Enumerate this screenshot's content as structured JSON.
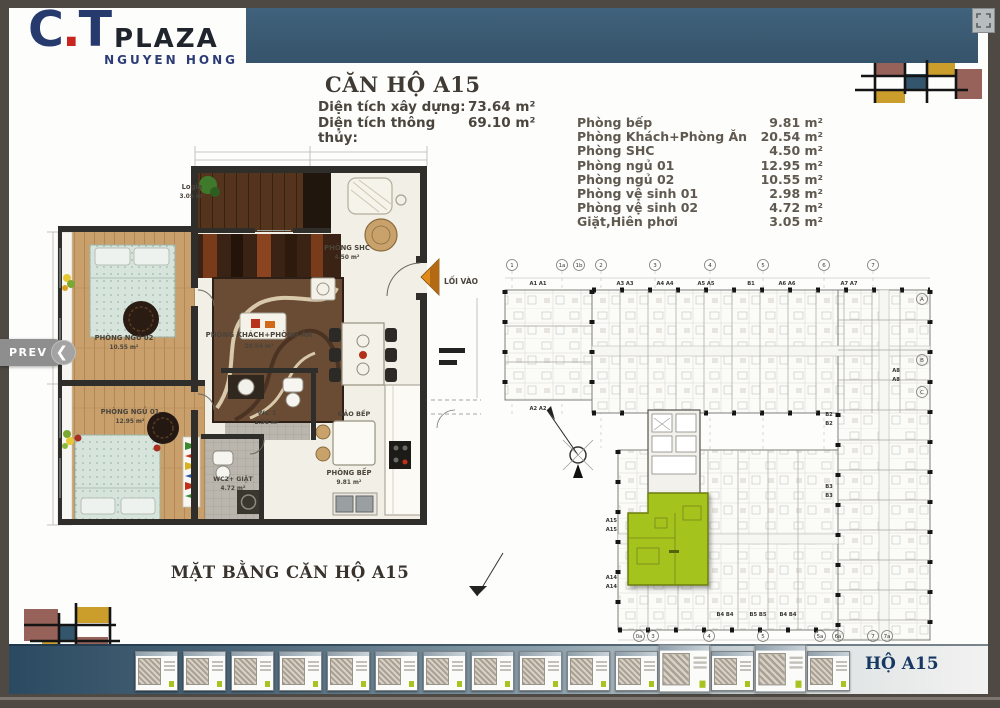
{
  "brand": {
    "c": "C",
    "dot": ".",
    "t": "T",
    "plaza": "PLAZA",
    "subtitle": "NGUYEN HONG"
  },
  "unit_header": {
    "title": "CĂN HỘ A15",
    "specs": [
      {
        "label": "Diện tích xây dựng:",
        "value": "73.64 m²"
      },
      {
        "label": "Diện tích thông thủy:",
        "value": "69.10 m²"
      }
    ]
  },
  "room_table": [
    {
      "name": "Phòng bếp",
      "area": "9.81 m²"
    },
    {
      "name": "Phòng Khách+Phòng Ăn",
      "area": "20.54 m²"
    },
    {
      "name": "Phòng SHC",
      "area": "4.50 m²"
    },
    {
      "name": "Phòng ngủ 01",
      "area": "12.95 m²"
    },
    {
      "name": "Phòng ngủ 02",
      "area": "10.55 m²"
    },
    {
      "name": "Phòng vệ sinh 01",
      "area": "2.98 m²"
    },
    {
      "name": "Phòng vệ sinh 02",
      "area": "4.72 m²"
    },
    {
      "name": "Giặt,Hiên phơi",
      "area": "3.05 m²"
    }
  ],
  "floor_plan": {
    "caption": "MẶT BẰNG CĂN HỘ A15",
    "entry": "LỐI VÀO",
    "rooms": {
      "logia": {
        "name": "Logia",
        "area": "3.05 m²"
      },
      "shc": {
        "name": "PHÒNG SHC",
        "area": "4.50 m²"
      },
      "bed2": {
        "name": "PHÒNG NGỦ 02",
        "area": "10.55 m²"
      },
      "living": {
        "name": "PHÒNG KHÁCH+PHÒNG ĂN",
        "area": "20.54 m²"
      },
      "bed1": {
        "name": "PHÒNG NGỦ 01",
        "area": "12.95 m²"
      },
      "wc1": {
        "name": "WC 1",
        "area": "2.98 m²"
      },
      "wc2": {
        "name": "WC2+ GIẶT",
        "area": "4.72 m²"
      },
      "island": {
        "name": "ĐẢO BẾP"
      },
      "kitchen": {
        "name": "PHÒNG BẾP",
        "area": "9.81 m²"
      }
    }
  },
  "site_plan": {
    "grid_top": [
      "1",
      "1a",
      "1b",
      "2",
      "3",
      "4",
      "5",
      "6",
      "7"
    ],
    "grid_bottom": [
      "0a",
      "3",
      "4",
      "5",
      "5a",
      "6a",
      "7",
      "7a"
    ],
    "grid_right": [
      "A",
      "B",
      "C"
    ],
    "units": [
      "A1 A1",
      "A3 A3",
      "A4 A4",
      "A5 A5",
      "B1",
      "A6 A6",
      "A7 A7",
      "A2 A2",
      "A8",
      "A8",
      "B2",
      "B2",
      "B3",
      "B3",
      "A15",
      "A15",
      "A14",
      "A14",
      "B4 B4",
      "B5 B5",
      "B4 B4"
    ],
    "highlighted_unit": "A15"
  },
  "nav": {
    "prev_label": "PREV"
  },
  "footer": {
    "active_label": "HỘ A15",
    "thumbnail_count": 15
  },
  "colors": {
    "highlight_green": "#a4c31d",
    "header_blue": "#3b5a70",
    "logo_navy": "#273a6e",
    "logo_red": "#c82520",
    "mondrian_gold": "#cb9d2b",
    "mondrian_mauve": "#96625a",
    "mondrian_teal": "#34566c"
  }
}
